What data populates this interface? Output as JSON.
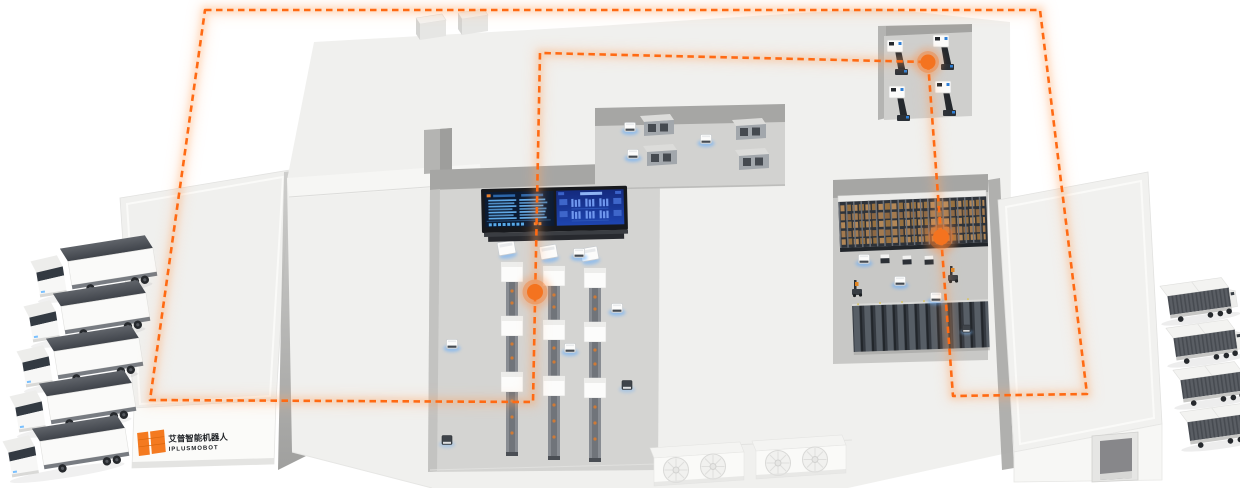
{
  "scene": {
    "background": "#ffffff",
    "view": "isometric-smart-factory"
  },
  "branding": {
    "company_name_zh": "艾普智能机器人",
    "company_name_en": "IPLUSMOBOT",
    "logo_mark_color": "#f47a20",
    "logo_text_color": "#1d2024"
  },
  "palette": {
    "route_orange": "#ff6a13",
    "waypoint_orange": "#f4731f",
    "glow_orange": "#ff8a3c",
    "agv_glow_blue": "#5aa9ff",
    "building_white": "#f0f0ee",
    "floor_gray": "#d4d4d2",
    "wall_shadow_gray": "#a6a6a4",
    "machine_gray": "#a2a7ac",
    "rack_dark": "#2e333a",
    "rack_box_brown": "#a0784e",
    "truck_container_dark": "#51555b",
    "screen_dark_panel": "#0b1b33",
    "screen_blue_panel": "#1e45b0",
    "screen_text_blue": "#5fa8e6"
  },
  "route": {
    "loop_path": "M205,10 L1040,10 L1087,394 L953,396 L928,62 L540,53 L533,402 L150,400 Z",
    "dash": "6.5 4.5",
    "stroke_width": 2.6
  },
  "waypoints": [
    {
      "id": "waypoint-production-line",
      "transform": "translate(535,292)"
    },
    {
      "id": "waypoint-racking-area",
      "transform": "translate(941,237)"
    },
    {
      "id": "waypoint-dock-bay",
      "transform": "translate(928,62)"
    }
  ],
  "fleet": {
    "trucks_left": 5,
    "trailers_right": 4,
    "agv_shuttles": 13,
    "forklift_robots": 2
  },
  "equipment": {
    "production_lines": 3,
    "workcells_top_bay": 4,
    "dock_stations_top_right": 4,
    "rack_rows_right": 2,
    "hvac_fan_units": 2,
    "roof_vents": 2,
    "control_dashboards": 1,
    "route_waypoints": 3
  }
}
